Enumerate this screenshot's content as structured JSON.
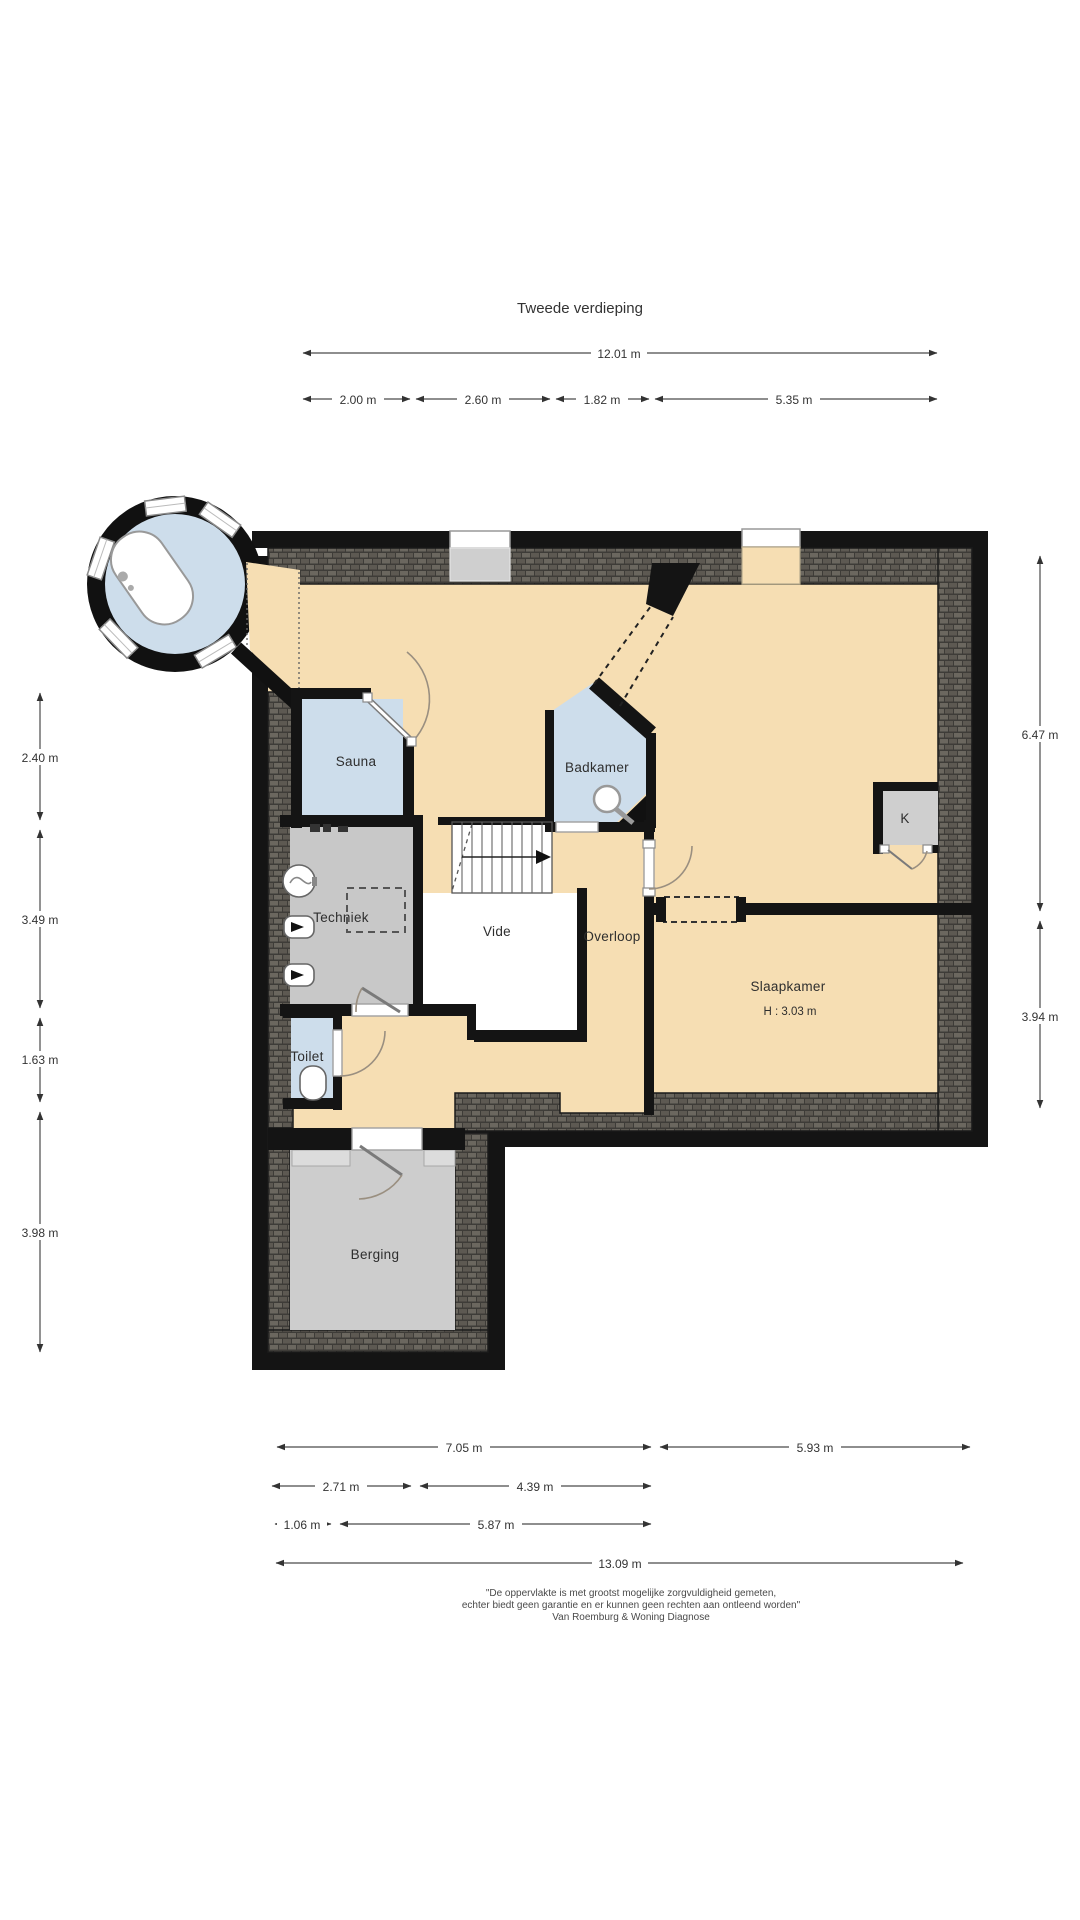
{
  "title": "Tweede verdieping",
  "rooms": {
    "sauna": "Sauna",
    "badkamer": "Badkamer",
    "techniek": "Techniek",
    "vide": "Vide",
    "overloop": "Overloop",
    "slaapkamer": "Slaapkamer",
    "slaapkamer_height": "H : 3.03 m",
    "toilet": "Toilet",
    "berging": "Berging",
    "kast": "K"
  },
  "dims": {
    "top_total": "12.01 m",
    "top_row": [
      "2.00 m",
      "2.60 m",
      "1.82 m",
      "5.35 m"
    ],
    "left": [
      "2.40 m",
      "3.49 m",
      "1.63 m",
      "3.98 m"
    ],
    "right": [
      "6.47 m",
      "3.94 m"
    ],
    "bottom_row1": [
      "7.05 m",
      "5.93 m"
    ],
    "bottom_row2": [
      "2.71 m",
      "4.39 m"
    ],
    "bottom_row3": [
      "1.06 m",
      "5.87 m"
    ],
    "bottom_total": "13.09 m"
  },
  "disclaimer": {
    "line1": "\"De oppervlakte is met grootst mogelijke zorgvuldigheid gemeten,",
    "line2": "echter biedt geen garantie en er kunnen geen rechten aan ontleend worden\"",
    "line3": "Van Roemburg & Woning Diagnose"
  },
  "colors": {
    "floor": "#f6deb3",
    "wet_room": "#cdddeb",
    "utility": "#c8c8c8",
    "storage": "#cdcdcd",
    "wall": "#141414",
    "roof_hatch": "#4e4c47",
    "dimension": "#333333"
  }
}
